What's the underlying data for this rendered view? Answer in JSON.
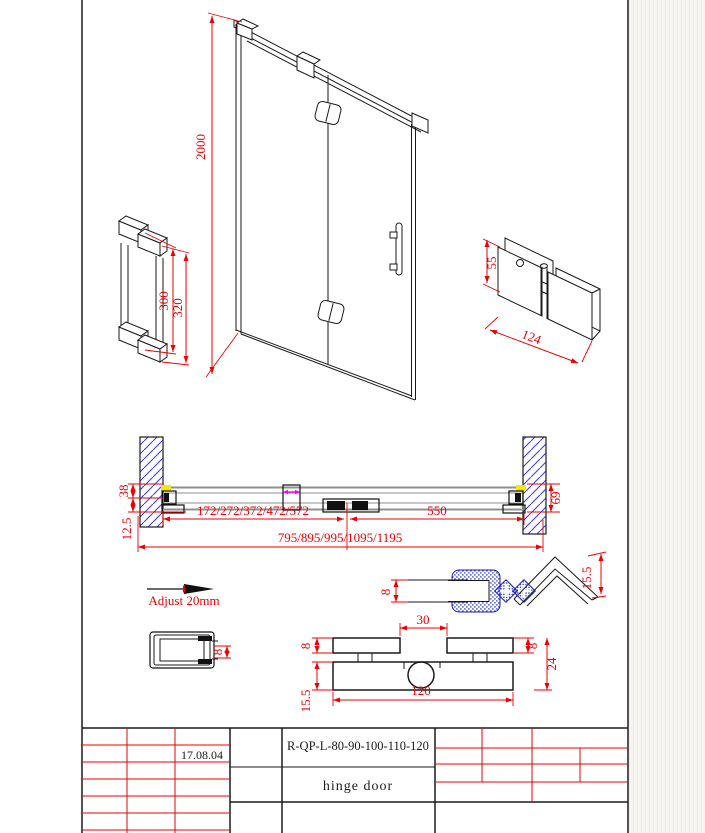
{
  "colors": {
    "dimension_red": "#ee0000",
    "line_black": "#1a1a1a",
    "hatch_blue": "#4040ee",
    "seal_blue": "#2233cc",
    "accent_yellow": "#f7e600",
    "accent_magenta": "#ff00ff",
    "track_gray": "#8f8f8f"
  },
  "door_view": {
    "height_dim": "2000"
  },
  "handle_detail": {
    "dim_300": "300",
    "dim_320": "320"
  },
  "hinge_detail": {
    "dim_55": "55",
    "dim_124": "124"
  },
  "plan_view": {
    "dim_38": "38",
    "dim_12_5": "12.5",
    "dim_69": "69",
    "dim_door_widths": "172/272/372/472/572",
    "dim_550": "550",
    "dim_total_widths": "795/895/995/1095/1195"
  },
  "adjust_note": {
    "label": "Adjust 20mm"
  },
  "magnet_seal_detail": {
    "dim_8": "8",
    "dim_15_5": "15.5"
  },
  "wall_profile_detail": {
    "dim_8": "8"
  },
  "hinge_plan_detail": {
    "dim_30": "30",
    "dim_8_left": "8",
    "dim_8_right": "8",
    "dim_24": "24",
    "dim_120": "120",
    "dim_15_5": "15.5"
  },
  "title_block": {
    "date": "17.08.04",
    "model_code": "R-QP-L-80-90-100-110-120",
    "product_name": "hinge door"
  }
}
